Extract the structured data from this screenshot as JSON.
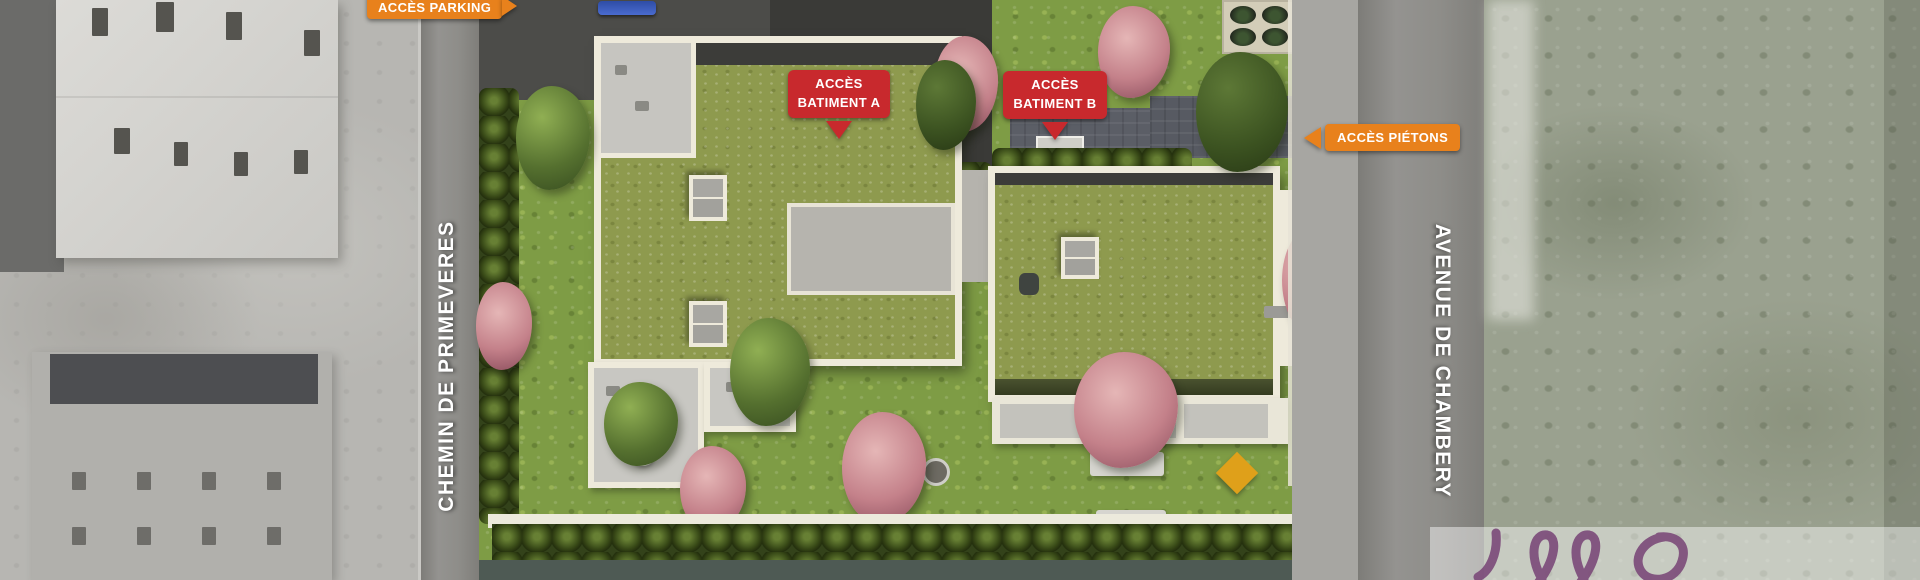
{
  "annotations": {
    "parking": {
      "label": "ACCÈS PARKING"
    },
    "batiment_a": {
      "line1": "ACCÈS",
      "line2": "BATIMENT A"
    },
    "batiment_b": {
      "line1": "ACCÈS",
      "line2": "BATIMENT B"
    },
    "pietons": {
      "label": "ACCÈS PIÉTONS"
    }
  },
  "streets": {
    "left": "CHEMIN DE PRIMEVERES",
    "right": "AVENUE DE CHAMBERY"
  },
  "colors": {
    "accent_orange": "#E8811C",
    "accent_red": "#C8292D",
    "roof_green": "#8E9A4E",
    "garden_green": "#7E9C45",
    "watermark_purple": "#7B4A79"
  },
  "icons": {
    "parking_arrow": "arrow-right-icon",
    "batiment_a_arrow": "arrow-down-icon",
    "batiment_b_arrow": "arrow-down-icon",
    "pietons_arrow": "arrow-left-icon"
  }
}
